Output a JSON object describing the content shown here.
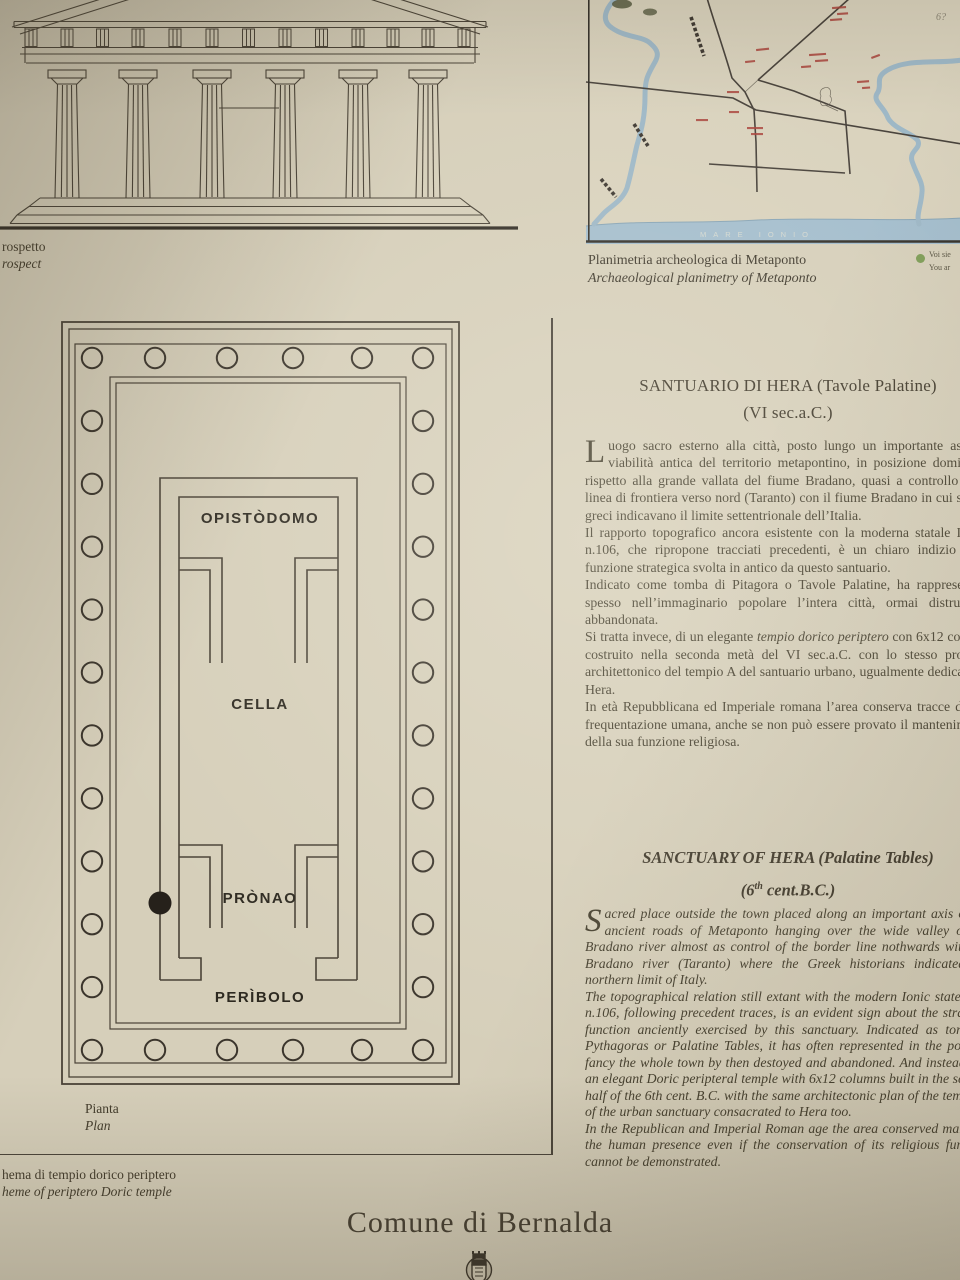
{
  "colors": {
    "paper": "#d6cfba",
    "ink": "#4a4337",
    "water": "#9db7c6",
    "sea": "#a3bdcd",
    "red_label": "#a8423a",
    "green_dot": "#7d9c55",
    "plan_dot": "#26211b"
  },
  "facade": {
    "caption_it": "rospetto",
    "caption_en": "rospect"
  },
  "map": {
    "caption_it": "Planimetria archeologica di Metaponto",
    "caption_en": "Archaeological planimetry of Metaponto",
    "legend_line1": "Voi sie",
    "legend_line2": "You ar",
    "sea_label": "MARE IONIO",
    "pencil_mark": "6?"
  },
  "plan": {
    "labels": {
      "opistodomo": "OPISTÒDOMO",
      "cella": "CELLA",
      "pronao": "PRÒNAO",
      "peribolo": "PERÌBOLO"
    },
    "caption_it": "Pianta",
    "caption_en": "Plan"
  },
  "scheme": {
    "caption_it": "hema di tempio dorico periptero",
    "caption_en": "heme of periptero Doric temple"
  },
  "text_it": {
    "title_line1": "SANTUARIO DI HERA (Tavole Palatine)",
    "title_line2": "(VI sec.a.C.)",
    "p1_drop": "L",
    "p1": "uogo sacro esterno alla città, posto lungo un importante asse di viabilità antica del territorio metapontino, in posizione dominante rispetto alla grande vallata del fiume Bradano, quasi a controllo della linea di frontiera verso nord (Taranto) con il fiume Bradano in cui storici greci indicavano il limite settentrionale dell’Italia.",
    "p2": "Il rapporto topografico ancora esistente con la moderna statale Ionica n.106, che ripropone tracciati precedenti, è un chiaro indizio della funzione strategica svolta in antico da questo santuario.",
    "p3": "Indicato come tomba di Pitagora o Tavole Palatine, ha rappresentato spesso nell’immaginario popolare l’intera città, ormai distrutta e abbandonata.",
    "p4_pre": "Si tratta invece, di un elegante ",
    "p4_italic": "tempio dorico periptero",
    "p4_post": " con 6x12 colonne costruito nella seconda metà del VI sec.a.C. con lo stesso progetto architettonico del tempio A del santuario urbano, ugualmente dedicato ad Hera.",
    "p5": "In età Repubblicana ed Imperiale romana l’area conserva tracce di una frequentazione umana, anche se non può essere provato il mantenimento della sua funzione religiosa."
  },
  "text_en": {
    "title_line1": "SANCTUARY OF HERA (Palatine Tables)",
    "title2_pre": "(6",
    "title2_sup": "th",
    "title2_post": " cent.B.C.)",
    "p1_drop": "S",
    "p1": "acred place outside the town placed along an important axis of the ancient roads of Metaponto hanging over the wide valley of the Bradano river almost as control of the border line nothwards with the Bradano river (Taranto) where the Greek historians indicated the northern limit of Italy.",
    "p2": "The topographical relation still extant with the modern Ionic state road n.106, following precedent traces, is an evident sign about the strategic function anciently exercised by this sanctuary. Indicated as tomb of Pythagoras or Palatine Tables, it has often represented in the popular fancy the whole town by then destoyed and abandoned. And instead it is an elegant Doric peripteral temple with 6x12 columns built in the second half of the 6th cent. B.C. with the same architectonic plan of the temple A of the urban sanctuary consacrated to Hera too.",
    "p3": "In the Republican and Imperial Roman age the area conserved marks of the human presence even if the conservation of its religious function cannot be demonstrated."
  },
  "footer": {
    "title": "Comune di Bernalda"
  }
}
